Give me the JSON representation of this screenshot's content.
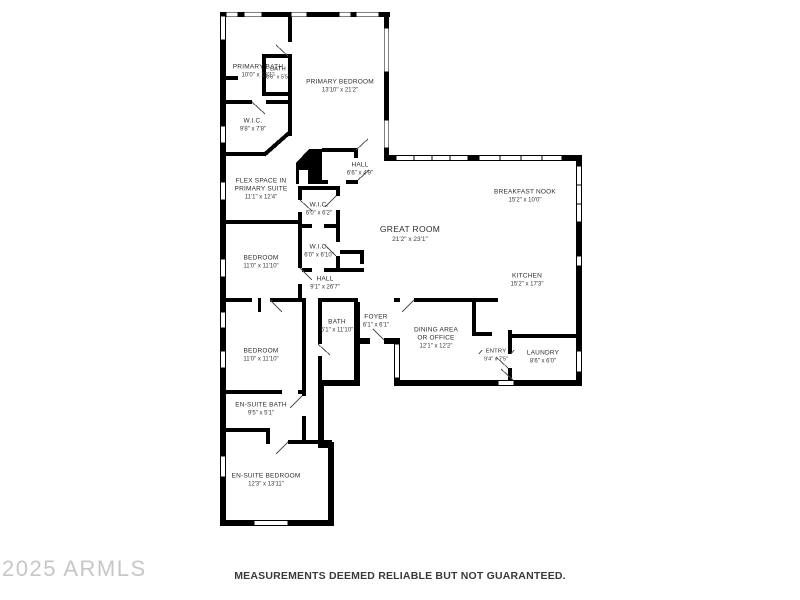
{
  "watermark": "2025 ARMLS",
  "disclaimer": "MEASUREMENTS DEEMED RELIABLE BUT NOT GUARANTEED.",
  "colors": {
    "wall": "#000000",
    "label_text": "#2e2e2e",
    "watermark": "#c7c7c7"
  },
  "rooms": [
    {
      "name": "PRIMARY BATH",
      "dims": "10'0\" x 13'1\""
    },
    {
      "name": "BATH",
      "dims": "8'0\" x 5'5\""
    },
    {
      "name": "PRIMARY BEDROOM",
      "dims": "13'10\" x 21'2\""
    },
    {
      "name": "W.I.C.",
      "dims": "9'8\" x 7'8\""
    },
    {
      "name": "HALL",
      "dims": "6'6\" x 4'9\""
    },
    {
      "name": "FLEX SPACE IN\nPRIMARY SUITE",
      "dims": "11'1\" x 12'4\""
    },
    {
      "name": "W.I.C.",
      "dims": "6'0\" x 6'2\""
    },
    {
      "name": "GREAT ROOM",
      "dims": "21'2\" x 23'1\""
    },
    {
      "name": "BREAKFAST NOOK",
      "dims": "15'2\" x 10'0\""
    },
    {
      "name": "BEDROOM",
      "dims": "11'0\" x 11'10\""
    },
    {
      "name": "W.I.C.",
      "dims": "6'0\" x 6'10\""
    },
    {
      "name": "HALL",
      "dims": "9'1\" x 26'7\""
    },
    {
      "name": "KITCHEN",
      "dims": "15'2\" x 17'3\""
    },
    {
      "name": "BATH",
      "dims": "5'1\" x 11'10\""
    },
    {
      "name": "FOYER",
      "dims": "6'1\" x 6'1\""
    },
    {
      "name": "DINING AREA\nOR OFFICE",
      "dims": "12'1\" x 12'2\""
    },
    {
      "name": "ENTRY",
      "dims": "9'4\" x 7'5\""
    },
    {
      "name": "LAUNDRY",
      "dims": "8'6\" x 6'0\""
    },
    {
      "name": "BEDROOM",
      "dims": "11'0\" x 11'10\""
    },
    {
      "name": "EN-SUITE BATH",
      "dims": "9'5\" x 5'1\""
    },
    {
      "name": "EN-SUITE BEDROOM",
      "dims": "12'3\" x 13'11\""
    }
  ]
}
